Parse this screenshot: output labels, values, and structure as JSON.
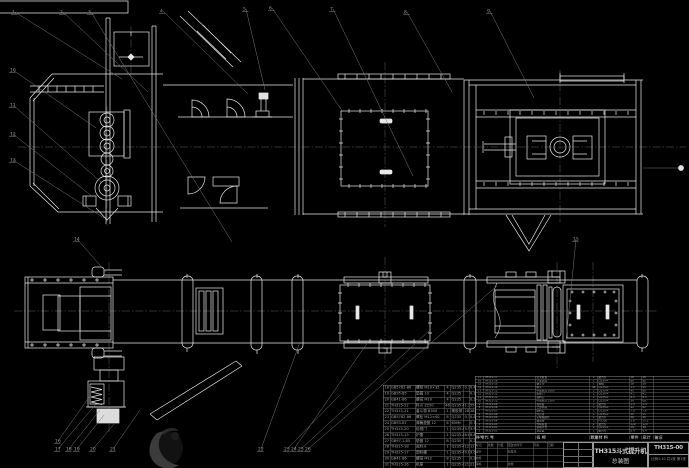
{
  "meta": {
    "background": "#000000",
    "line_color": "#e8e8e8",
    "dim_color": "#8a8a8a",
    "watermark_color": "#3b3b3b"
  },
  "title_block": {
    "title_line1": "TH315斗式提升机",
    "title_line2": "总装图",
    "drawing_no": "TH315-00",
    "footer": "比例1:10 共1张 第1张",
    "sig_labels": [
      [
        "标记",
        "处数",
        "分区",
        "更改文件号",
        "签名",
        "日期"
      ],
      [
        "设计",
        "",
        "",
        "标准化",
        "",
        ""
      ],
      [
        "校核",
        "",
        "",
        "",
        "",
        ""
      ],
      [
        "审核",
        "",
        "",
        "批准",
        "",
        ""
      ]
    ]
  },
  "bom_right": {
    "headers": [
      "序号",
      "代  号",
      "名  称",
      "数量",
      "材  料",
      "单件",
      "总计",
      "备注"
    ],
    "rows": [
      [
        "17",
        "TH315-17",
        "张紧装置",
        "1",
        "组合件",
        "16",
        "16",
        ""
      ],
      [
        "16",
        "TH315-16",
        "下部区段",
        "1",
        "Q235-A",
        "86",
        "86",
        ""
      ],
      [
        "15",
        "TH315-15",
        "畚斗带",
        "1",
        "橡胶",
        "28",
        "28",
        ""
      ],
      [
        "14",
        "TH315-14",
        "料斗",
        "46",
        "Q235-A",
        "1.2",
        "55",
        ""
      ],
      [
        "13",
        "TH315-13",
        "中部机壳 2000",
        "2",
        "Q235-A",
        "45",
        "90",
        ""
      ],
      [
        "12",
        "TH315-12",
        "检修门",
        "1",
        "Q235-A",
        "4.2",
        "4.2",
        ""
      ],
      [
        "11",
        "TH315-11",
        "进料口",
        "1",
        "Q235-A",
        "8.5",
        "8.5",
        ""
      ],
      [
        "10",
        "TH315-10",
        "中间机壳 1500",
        "2",
        "Q235-A",
        "34",
        "68",
        ""
      ],
      [
        "9",
        "TH315-09",
        "观察窗",
        "1",
        "组合件",
        "2.4",
        "2.4",
        ""
      ],
      [
        "8",
        "TH315-08",
        "上部区段",
        "1",
        "Q235-A",
        "92",
        "92",
        ""
      ],
      [
        "7",
        "TH315-07",
        "卸料口",
        "1",
        "Q235-A",
        "7.8",
        "7.8",
        ""
      ],
      [
        "6",
        "TH315-06",
        "外壳罩",
        "1",
        "Q235-A",
        "15",
        "15",
        ""
      ],
      [
        "5",
        "TH315-05",
        "主动轴部件",
        "1",
        "组合件",
        "46",
        "46",
        ""
      ],
      [
        "4",
        "TH315-04",
        "轴承座",
        "2",
        "HT200",
        "5.6",
        "11.2",
        ""
      ],
      [
        "3",
        "TH315-03",
        "传动装置",
        "1",
        "组合件",
        "120",
        "120",
        ""
      ],
      [
        "2",
        "TH315-02",
        "驱动平台",
        "1",
        "Q235-A",
        "38",
        "38",
        ""
      ],
      [
        "1",
        "TH315-01",
        "逆止器",
        "1",
        "组合件",
        "6.4",
        "6.4",
        ""
      ]
    ]
  },
  "bom_left": {
    "rows": [
      [
        "18",
        "GB5782-86",
        "螺栓 M10×35",
        "4",
        "Q235",
        "0.1",
        "0.4"
      ],
      [
        "19",
        "GB95-85",
        "垫圈 10",
        "4",
        "Q235",
        "",
        "0.1"
      ],
      [
        "20",
        "GB41-86",
        "螺母 M10",
        "4",
        "Q235",
        "",
        "0.1"
      ],
      [
        "21",
        "TH315-22",
        "料斗 Z250",
        "46",
        "Q235-A",
        "1.2",
        "55"
      ],
      [
        "22",
        "TH315-21",
        "畚斗带 B300",
        "1",
        "橡胶带",
        "28",
        "28"
      ],
      [
        "23",
        "GB5782-86",
        "螺栓 M12×40",
        "8",
        "Q235",
        "0.1",
        "0.8"
      ],
      [
        "24",
        "GB93-87",
        "弹簧垫圈 12",
        "8",
        "65Mn",
        "",
        "0.1"
      ],
      [
        "25",
        "TH315-20",
        "检视门",
        "1",
        "Q235-A",
        "3.5",
        "3.5"
      ],
      [
        "26",
        "TH315-19",
        "护罩",
        "1",
        "Q235-A",
        "6.8",
        "6.8"
      ],
      [
        "27",
        "GB97.1-85",
        "垫圈 12",
        "8",
        "Q235",
        "",
        "0.2"
      ],
      [
        "28",
        "TH315-18",
        "进料斗",
        "1",
        "Q235-A",
        "12",
        "12"
      ],
      [
        "29",
        "TH315-17",
        "卸料槽",
        "1",
        "Q235-A",
        "9.6",
        "9.6"
      ],
      [
        "30",
        "GB41-86",
        "螺母 M12",
        "8",
        "Q235",
        "",
        "0.2"
      ],
      [
        "31",
        "TH315-16",
        "机座",
        "1",
        "Q235-A",
        "21",
        "21"
      ]
    ]
  },
  "callouts": [
    {
      "n": "1",
      "x": 12,
      "y": 10,
      "tx": 122,
      "ty": 79
    },
    {
      "n": "2",
      "x": 60,
      "y": 10,
      "tx": 148,
      "ty": 92
    },
    {
      "n": "3",
      "x": 88,
      "y": 10,
      "tx": 232,
      "ty": 242
    },
    {
      "n": "4",
      "x": 160,
      "y": 9,
      "tx": 248,
      "ty": 94
    },
    {
      "n": "5",
      "x": 243,
      "y": 7,
      "tx": 265,
      "ty": 90
    },
    {
      "n": "6",
      "x": 269,
      "y": 6,
      "tx": 343,
      "ty": 112
    },
    {
      "n": "7",
      "x": 330,
      "y": 7,
      "tx": 413,
      "ty": 176
    },
    {
      "n": "8",
      "x": 404,
      "y": 10,
      "tx": 452,
      "ty": 92
    },
    {
      "n": "9",
      "x": 487,
      "y": 9,
      "tx": 534,
      "ty": 98
    },
    {
      "n": "10",
      "x": 10,
      "y": 68,
      "tx": 96,
      "ty": 128
    },
    {
      "n": "11",
      "x": 10,
      "y": 103,
      "tx": 101,
      "ty": 182
    },
    {
      "n": "12",
      "x": 10,
      "y": 132,
      "tx": 93,
      "ty": 197
    },
    {
      "n": "13",
      "x": 10,
      "y": 158,
      "tx": 104,
      "ty": 218
    },
    {
      "n": "14",
      "x": 74,
      "y": 237,
      "tx": 106,
      "ty": 272
    },
    {
      "n": "15",
      "x": 573,
      "y": 237,
      "tx": 566,
      "ty": 340
    },
    {
      "n": "16",
      "x": 55,
      "y": 439,
      "tx": 90,
      "ty": 396
    },
    {
      "n": "17",
      "x": 55,
      "y": 447,
      "tx": 96,
      "ty": 404
    },
    {
      "n": "18",
      "x": 66,
      "y": 447,
      "tx": 100,
      "ty": 410
    },
    {
      "n": "19",
      "x": 74,
      "y": 447,
      "tx": 104,
      "ty": 415
    },
    {
      "n": "20",
      "x": 90,
      "y": 447,
      "tx": 114,
      "ty": 424
    },
    {
      "n": "21",
      "x": 110,
      "y": 447,
      "tx": 140,
      "ty": 410
    },
    {
      "n": "22",
      "x": 258,
      "y": 447,
      "tx": 300,
      "ty": 342
    },
    {
      "n": "23",
      "x": 284,
      "y": 447,
      "tx": 340,
      "ty": 395
    },
    {
      "n": "24",
      "x": 291,
      "y": 447,
      "tx": 368,
      "ty": 342
    },
    {
      "n": "25",
      "x": 298,
      "y": 447,
      "tx": 430,
      "ty": 330
    },
    {
      "n": "26",
      "x": 305,
      "y": 447,
      "tx": 497,
      "ty": 286
    }
  ]
}
